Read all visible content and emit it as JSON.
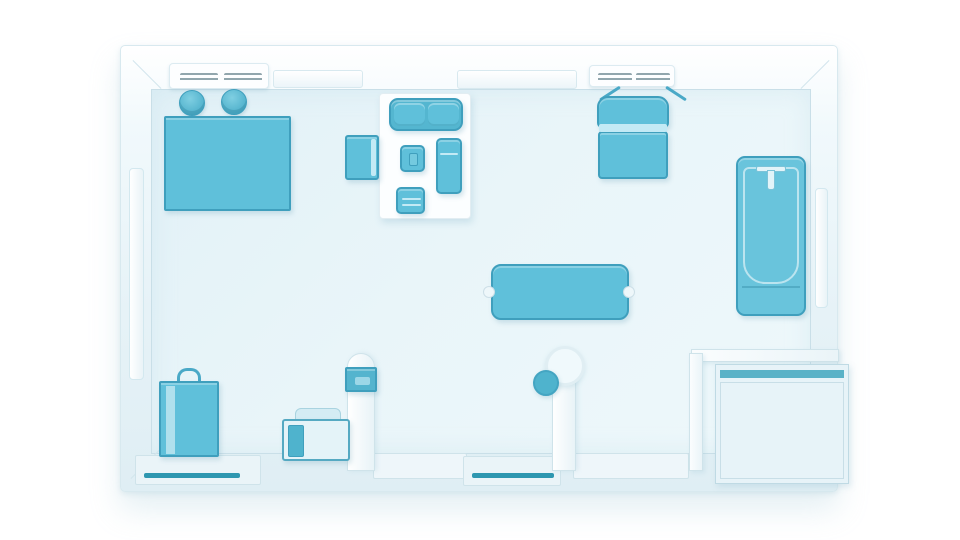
{
  "scene": {
    "name": "apartment-floor-plan-top-view",
    "style": "3d-rendered top-down floor plan, monochromatic light blue",
    "visible_text": []
  },
  "palette": {
    "background": "#ffffff",
    "floor": "#e9f5f9",
    "wall-face": "#f5fbfd",
    "wall-edge": "#cfe3ea",
    "furniture": "#5fc0da",
    "furniture-dark": "#3f9fbd",
    "furniture-light": "#c3eaf5",
    "accent-teal": "#2e97b0",
    "fixture-white": "#f2fafc"
  },
  "inventory": {
    "wall_fixtures": [
      "air-conditioner",
      "air-conditioner",
      "top-window",
      "top-window",
      "left-wall-window",
      "right-wall-window",
      "bottom-window-with-sill",
      "bottom-window-with-sill",
      "bottom-wall-recess",
      "bottom-wall-recess"
    ],
    "furniture": [
      "double-bed",
      "bedside-stool",
      "bedside-stool",
      "area-rug",
      "loveseat-sofa",
      "armchair",
      "coffee-table",
      "chaise-seat",
      "ottoman",
      "wall-hung-bed",
      "bathtub",
      "dining-table",
      "support-column-with-band",
      "support-column",
      "round-side-table",
      "floor-stool",
      "tote-bag",
      "storage-box",
      "bathroom-partition",
      "shower-pan"
    ]
  }
}
